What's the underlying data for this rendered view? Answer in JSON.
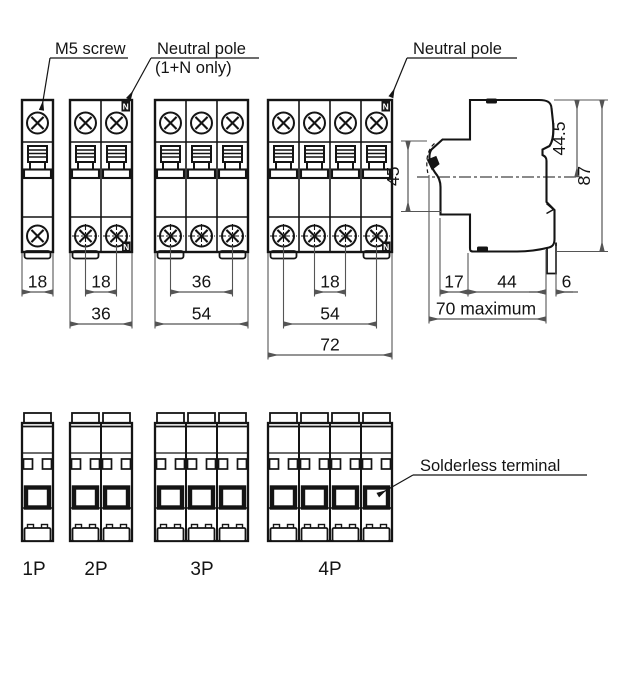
{
  "canvas": {
    "width": 635,
    "height": 681,
    "bg": "#ffffff",
    "ink": "#141414",
    "dim_ink": "#555555"
  },
  "annotations": {
    "m5_screw": "M5 screw",
    "neutral_pole_top": "Neutral pole",
    "neutral_pole_top_sub": "(1+N only)",
    "neutral_pole_right": "Neutral pole",
    "solderless_terminal": "Solderless terminal",
    "n_badge": "N"
  },
  "front_views": [
    {
      "id": "1p",
      "poles": 1,
      "x": 22,
      "neutral_badges": false,
      "feet": [
        0
      ],
      "dims": [
        {
          "value": "18",
          "row": 0,
          "ref": "edges"
        }
      ]
    },
    {
      "id": "2p",
      "poles": 2,
      "x": 70,
      "neutral_badges": true,
      "feet": [
        0
      ],
      "dims": [
        {
          "value": "18",
          "row": 0,
          "ref": "screws",
          "from": 0,
          "to": 1
        },
        {
          "value": "36",
          "row": 1,
          "ref": "edges"
        }
      ]
    },
    {
      "id": "3p",
      "poles": 3,
      "x": 155,
      "neutral_badges": false,
      "feet": [
        0,
        2
      ],
      "dims": [
        {
          "value": "36",
          "row": 0,
          "ref": "screws",
          "from": 0,
          "to": 2
        },
        {
          "value": "54",
          "row": 1,
          "ref": "edges"
        }
      ]
    },
    {
      "id": "4p",
      "poles": 4,
      "x": 268,
      "neutral_badges": true,
      "feet": [
        0,
        3
      ],
      "dims": [
        {
          "value": "18",
          "row": 0,
          "ref": "screws",
          "from": 1,
          "to": 2
        },
        {
          "value": "54",
          "row": 1,
          "ref": "screws",
          "from": 0,
          "to": 3
        },
        {
          "value": "72",
          "row": 2,
          "ref": "edges"
        }
      ]
    }
  ],
  "bottom_views": [
    {
      "label": "1P",
      "poles": 1,
      "x": 22
    },
    {
      "label": "2P",
      "poles": 2,
      "x": 70
    },
    {
      "label": "3P",
      "poles": 3,
      "x": 155
    },
    {
      "label": "4P",
      "poles": 4,
      "x": 268
    }
  ],
  "side_view": {
    "dims": {
      "toggle_height": "45",
      "upper_depth": "44.5",
      "total_height": "87",
      "front": "17",
      "body": "44",
      "clip": "6",
      "max_depth": "70 maximum"
    }
  }
}
